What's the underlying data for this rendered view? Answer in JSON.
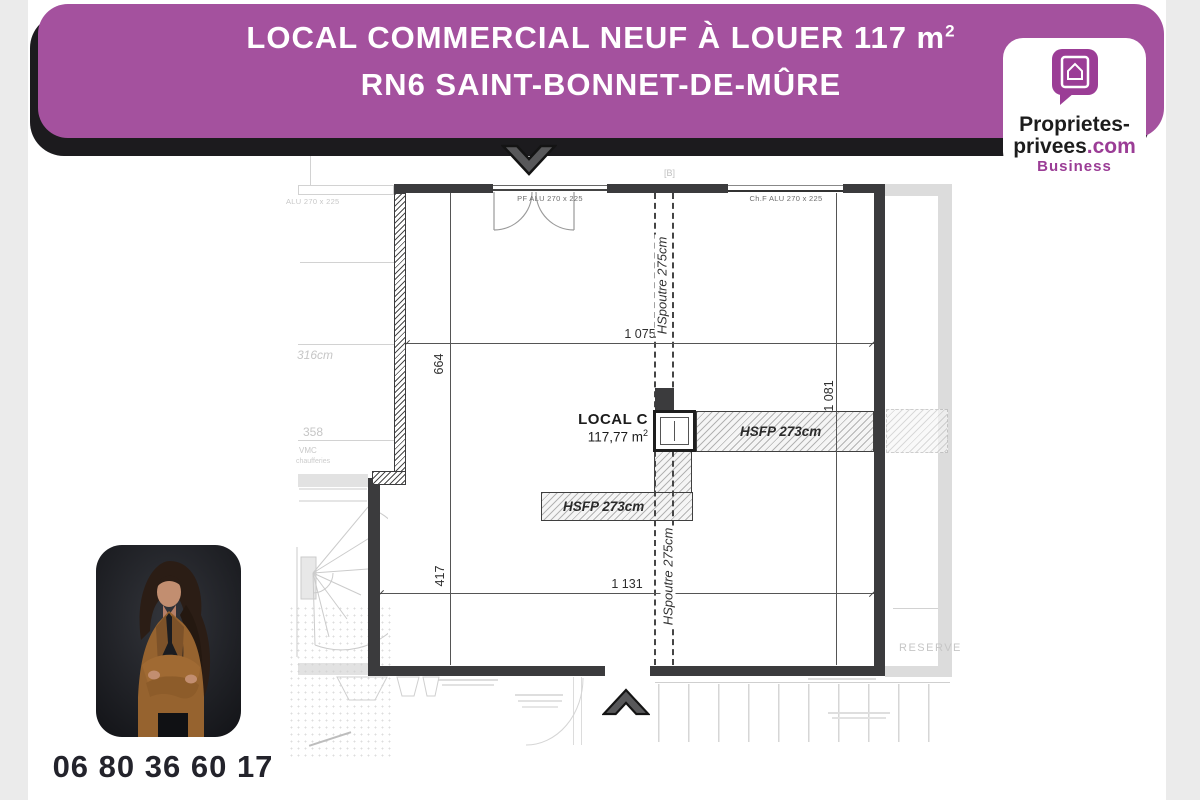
{
  "header": {
    "line1": "LOCAL COMMERCIAL NEUF À LOUER 117 m",
    "line1_sup": "2",
    "line2": "RN6 SAINT-BONNET-DE-MÛRE",
    "accent_color": "#A4519E"
  },
  "logo": {
    "line1": "Proprietes-",
    "line2_black": "privees",
    "line2_accent": ".com",
    "line3": "Business",
    "accent_color": "#9B3D96"
  },
  "plan": {
    "room": {
      "name": "LOCAL C",
      "area": "117,77 m",
      "area_sup": "2"
    },
    "dims": {
      "top_width": "1 075",
      "bottom_width": "1 131",
      "left_upper": "664",
      "left_lower": "417",
      "right": "1 081"
    },
    "beams": {
      "upper": "HSpoutre 275cm",
      "lower": "HSpoutre 275cm"
    },
    "ceiling": {
      "right": "HSFP 273cm",
      "left": "HSFP 273cm"
    },
    "openings": {
      "door_top": "PF ALU 270 x 225",
      "window_top_right": "Ch.F ALU 270 x 225",
      "faint_left": "ALU 270 x 225"
    },
    "annotations": {
      "b_marker": "[B]",
      "reserve": "RESERVE",
      "dim_316": "316cm",
      "dim_358": "358",
      "vmc_line1": "VMC",
      "vmc_line2": "chaufferies"
    },
    "wall_color": "#3B3B3D"
  },
  "contact": {
    "phone": "06 80 36 60 17"
  }
}
